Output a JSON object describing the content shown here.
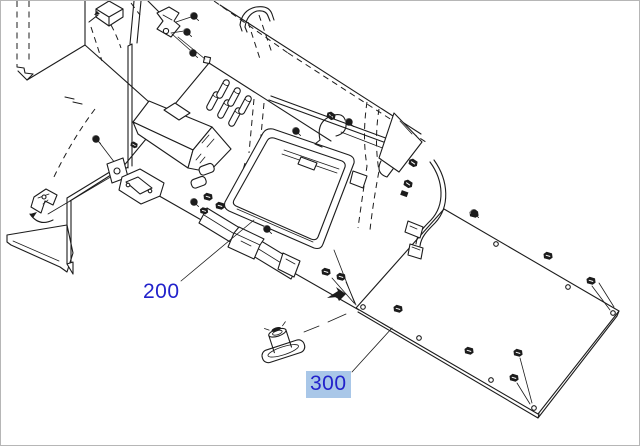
{
  "figure": {
    "kind": "exploded-parts-diagram",
    "description": "Isometric exploded service-manual view of a main board assembly and rear shield plate with screws, clips, cable harness and dashed assembly guide lines"
  },
  "canvas": {
    "width": 640,
    "height": 446
  },
  "colors": {
    "line": "#1c1c1c",
    "label_text": "#2222cb",
    "highlight_bg": "#a9c7e8",
    "canvas_bg": "#ffffff",
    "canvas_border": "#b6b6b6"
  },
  "callouts": [
    {
      "ref": "200",
      "highlighted": false
    },
    {
      "ref": "300",
      "highlighted": true
    }
  ]
}
